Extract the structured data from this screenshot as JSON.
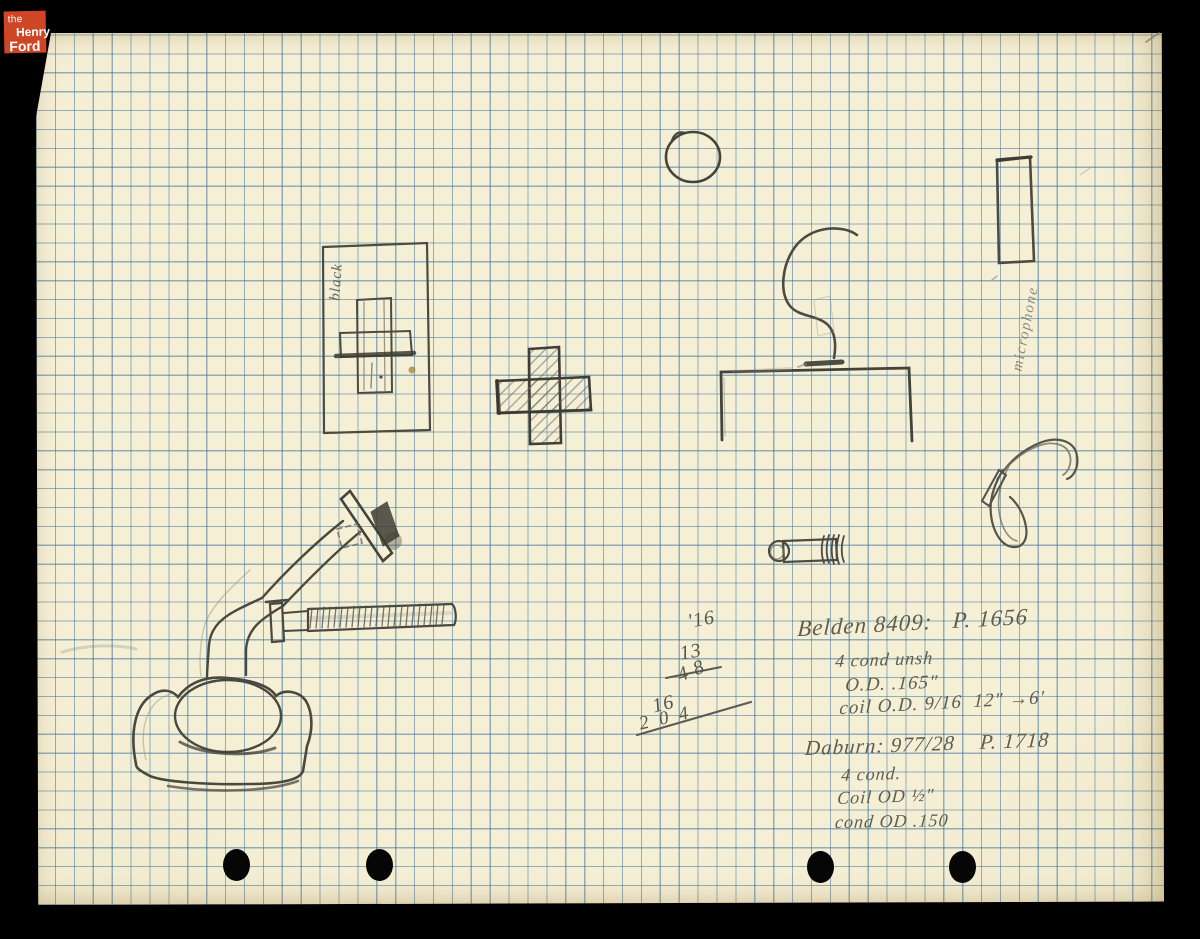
{
  "logo": {
    "the": "the",
    "henry": "Henry",
    "ford": "Ford"
  },
  "labels": {
    "black": "black",
    "microphone": "microphone"
  },
  "calc": {
    "r1": "'16",
    "r2": "13",
    "r3": "4 8",
    "r4": "16",
    "r5": "2 0 4"
  },
  "notes": [
    "Belden 8409:   P. 1656",
    "4 cond unsh",
    "O.D. .165\"",
    "coil O.D. 9/16  12\" →6'",
    "Daburn: 977/28    P. 1718",
    "4 cond.",
    "Coil OD ½\"",
    "cond OD .150"
  ],
  "colors": {
    "background": "#000000",
    "paper": "#f2ebcf",
    "grid_blue": "#5d90b4",
    "pencil": "#55544a",
    "logo_red": "#cf4627"
  }
}
